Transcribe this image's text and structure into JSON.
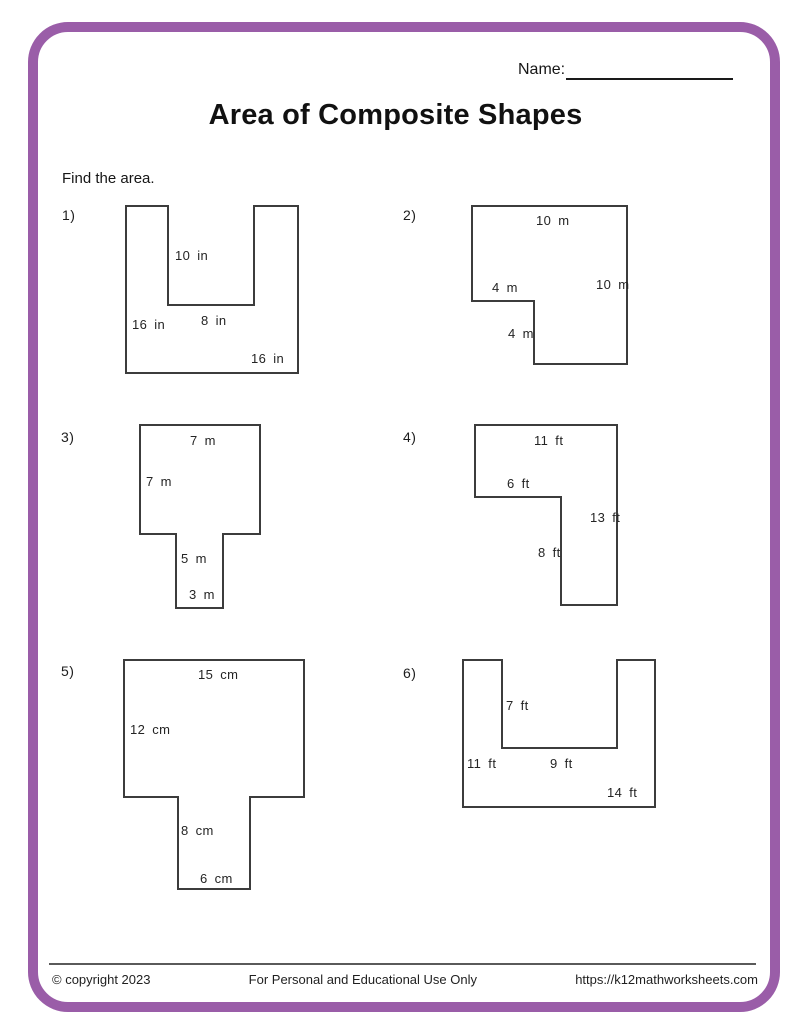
{
  "header": {
    "name_label": "Name:",
    "title": "Area of Composite Shapes",
    "instruction": "Find the area."
  },
  "colors": {
    "accent_border": "#9a5da8",
    "shape_stroke": "#3c3c3c"
  },
  "problems": [
    {
      "number": "1)",
      "shape": "u-shape-notch-top",
      "labels": [
        "10 in",
        "8 in",
        "16 in",
        "16 in"
      ]
    },
    {
      "number": "2)",
      "shape": "square-notch-bottom-left",
      "labels": [
        "10 m",
        "4 m",
        "10 m",
        "4 m"
      ]
    },
    {
      "number": "3)",
      "shape": "t-shape-stem-down",
      "labels": [
        "7 m",
        "7 m",
        "5 m",
        "3 m"
      ]
    },
    {
      "number": "4)",
      "shape": "l-shape",
      "labels": [
        "11 ft",
        "6 ft",
        "13 ft",
        "8 ft"
      ]
    },
    {
      "number": "5)",
      "shape": "t-shape-stem-down",
      "labels": [
        "15 cm",
        "12 cm",
        "8 cm",
        "6 cm"
      ]
    },
    {
      "number": "6)",
      "shape": "u-shape-notch-top",
      "labels": [
        "7 ft",
        "11 ft",
        "9 ft",
        "14 ft"
      ]
    }
  ],
  "footer": {
    "copyright": "© copyright 2023",
    "usage": "For Personal and Educational Use Only",
    "url": "https://k12mathworksheets.com"
  }
}
